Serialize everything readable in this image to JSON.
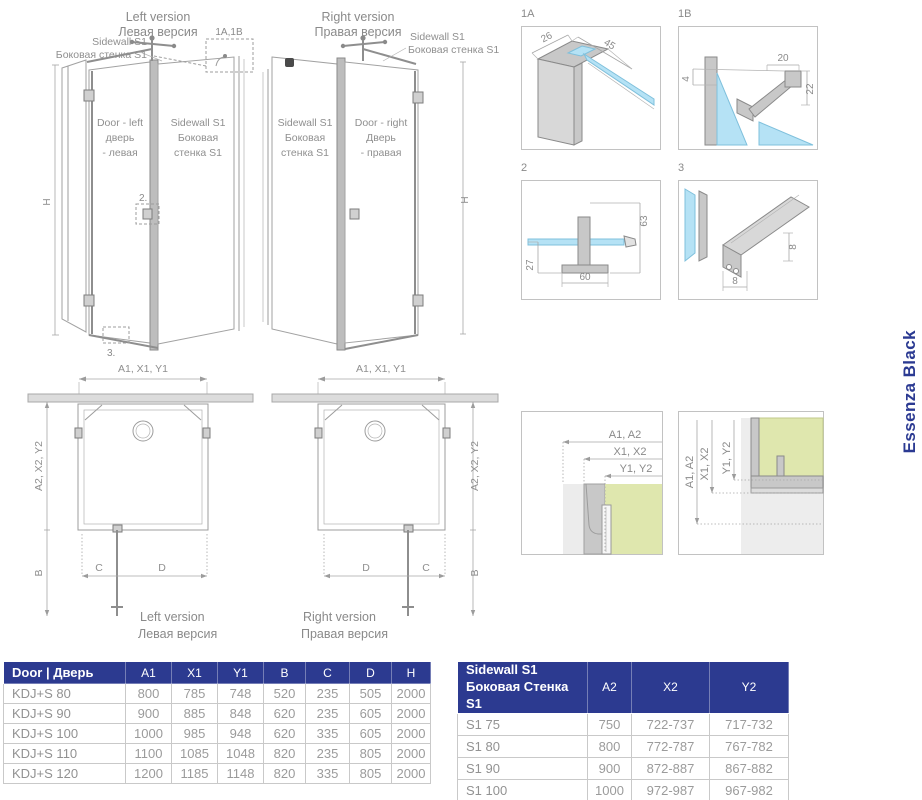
{
  "side_label": "Essenza Black",
  "colors": {
    "accent_navy": "#2c3a90",
    "brand_blue": "#2b3a92",
    "glass_blue": "#b5e2f5",
    "glass_green": "#dfe7ae",
    "line_grey": "#9c9c9c"
  },
  "elev_left": {
    "title_en": "Left version",
    "title_ru": "Левая версия",
    "callout_line1": "Sidewall S1",
    "callout_line2": "Боковая стенка S1",
    "door_line1": "Door - left",
    "door_line2": "дверь",
    "door_line3": "- левая",
    "side_line1": "Sidewall S1",
    "side_line2": "Боковая",
    "side_line3": "стенка S1",
    "ref_top": "1A,1B",
    "ref_handle": "2.",
    "ref_bottom": "3.",
    "dim_h": "H"
  },
  "elev_right": {
    "title_en": "Right version",
    "title_ru": "Правая версия",
    "callout_line1": "Sidewall S1",
    "callout_line2": "Боковая стенка S1",
    "door_line1": "Door - right",
    "door_line2": "Дверь",
    "door_line3": "- правая",
    "side_line1": "Sidewall S1",
    "side_line2": "Боковая",
    "side_line3": "стенка S1",
    "dim_h": "H"
  },
  "plan_left": {
    "dim_top": "A1, X1, Y1",
    "dim_side": "A2, X2, Y2",
    "dim_b": "B",
    "dim_c": "C",
    "dim_d": "D",
    "caption_en": "Left version",
    "caption_ru": "Левая версия"
  },
  "plan_right": {
    "dim_top": "A1, X1, Y1",
    "dim_side": "A2, X2, Y2",
    "dim_b": "B",
    "dim_c": "C",
    "dim_d": "D",
    "caption_en": "Right version",
    "caption_ru": "Правая версия"
  },
  "details": {
    "d1a": {
      "label": "1A",
      "dim1": "26",
      "dim2": "45"
    },
    "d1b": {
      "label": "1B",
      "dim1": "20",
      "dim2": "4",
      "dim3": "22"
    },
    "d2": {
      "label": "2",
      "dim1": "63",
      "dim2": "27",
      "dim3": "60"
    },
    "d3": {
      "label": "3",
      "dim1": "8",
      "dim2": "8"
    },
    "corner_a": {
      "dim1": "A1, A2",
      "dim2": "X1, X2",
      "dim3": "Y1, Y2"
    },
    "corner_b": {
      "dim1": "A1, A2",
      "dim2": "X1, X2",
      "dim3": "Y1, Y2"
    }
  },
  "door_table": {
    "title": "Door | Дверь",
    "columns": [
      "A1",
      "X1",
      "Y1",
      "B",
      "C",
      "D",
      "H"
    ],
    "rows": [
      {
        "model": "KDJ+S 80",
        "values": [
          "800",
          "785",
          "748",
          "520",
          "235",
          "505",
          "2000"
        ]
      },
      {
        "model": "KDJ+S 90",
        "values": [
          "900",
          "885",
          "848",
          "620",
          "235",
          "605",
          "2000"
        ]
      },
      {
        "model": "KDJ+S 100",
        "values": [
          "1000",
          "985",
          "948",
          "620",
          "335",
          "605",
          "2000"
        ]
      },
      {
        "model": "KDJ+S 110",
        "values": [
          "1100",
          "1085",
          "1048",
          "820",
          "235",
          "805",
          "2000"
        ]
      },
      {
        "model": "KDJ+S 120",
        "values": [
          "1200",
          "1185",
          "1148",
          "820",
          "335",
          "805",
          "2000"
        ]
      }
    ]
  },
  "sidewall_table": {
    "title_en": "Sidewall S1",
    "title_ru": "Боковая Стенка S1",
    "columns": [
      "A2",
      "X2",
      "Y2"
    ],
    "rows": [
      {
        "model": "S1 75",
        "values": [
          "750",
          "722-737",
          "717-732"
        ]
      },
      {
        "model": "S1 80",
        "values": [
          "800",
          "772-787",
          "767-782"
        ]
      },
      {
        "model": "S1 90",
        "values": [
          "900",
          "872-887",
          "867-882"
        ]
      },
      {
        "model": "S1 100",
        "values": [
          "1000",
          "972-987",
          "967-982"
        ]
      }
    ]
  }
}
